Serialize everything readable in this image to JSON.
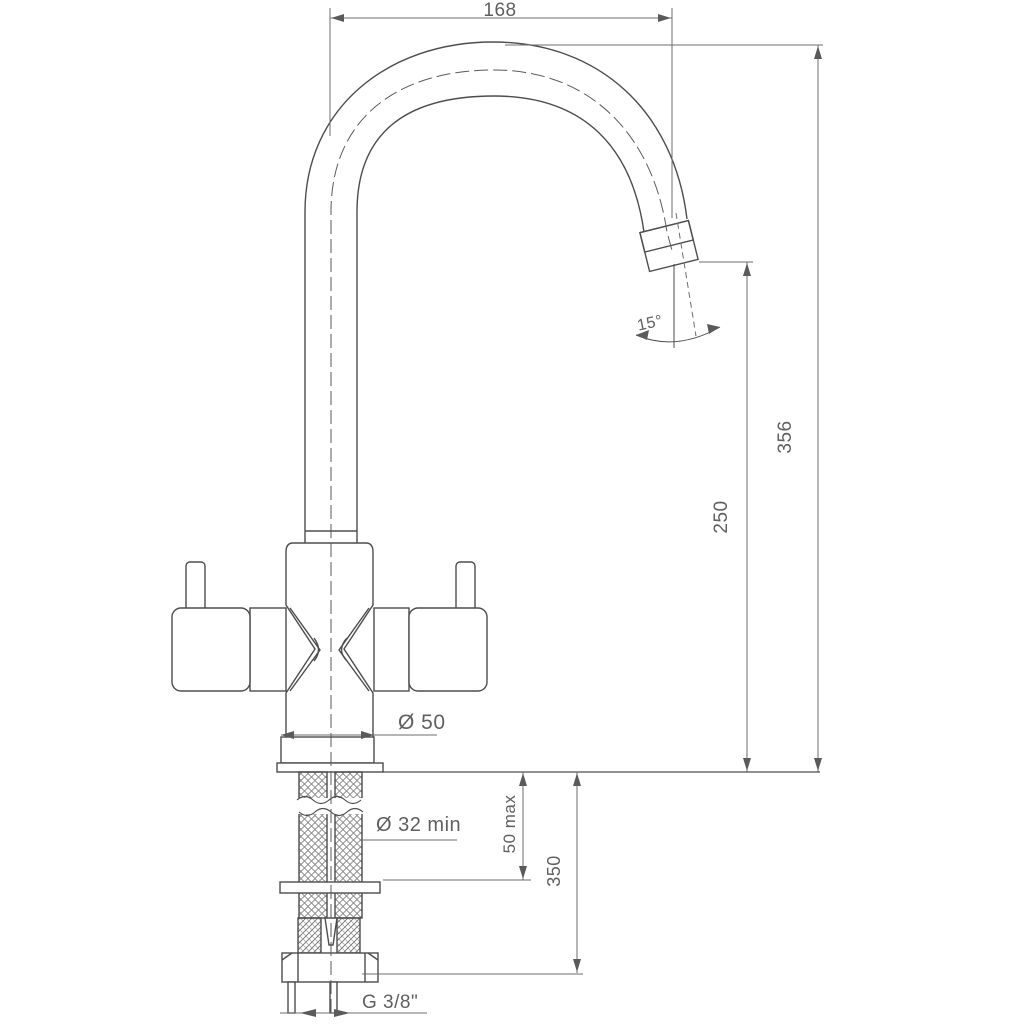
{
  "drawing": {
    "dimensions": {
      "spout_reach": "168",
      "total_height": "356",
      "spout_height": "250",
      "spout_angle": "15°",
      "base_diameter": "Ø 50",
      "hole_diameter": "Ø 32 min",
      "deck_thickness": "50 max",
      "hose_length": "350",
      "thread_size": "G 3/8\""
    },
    "colors": {
      "line": "#4d4d4d",
      "dim_line": "#6e6e6e",
      "text": "#5f5f5f",
      "background": "#ffffff"
    }
  }
}
